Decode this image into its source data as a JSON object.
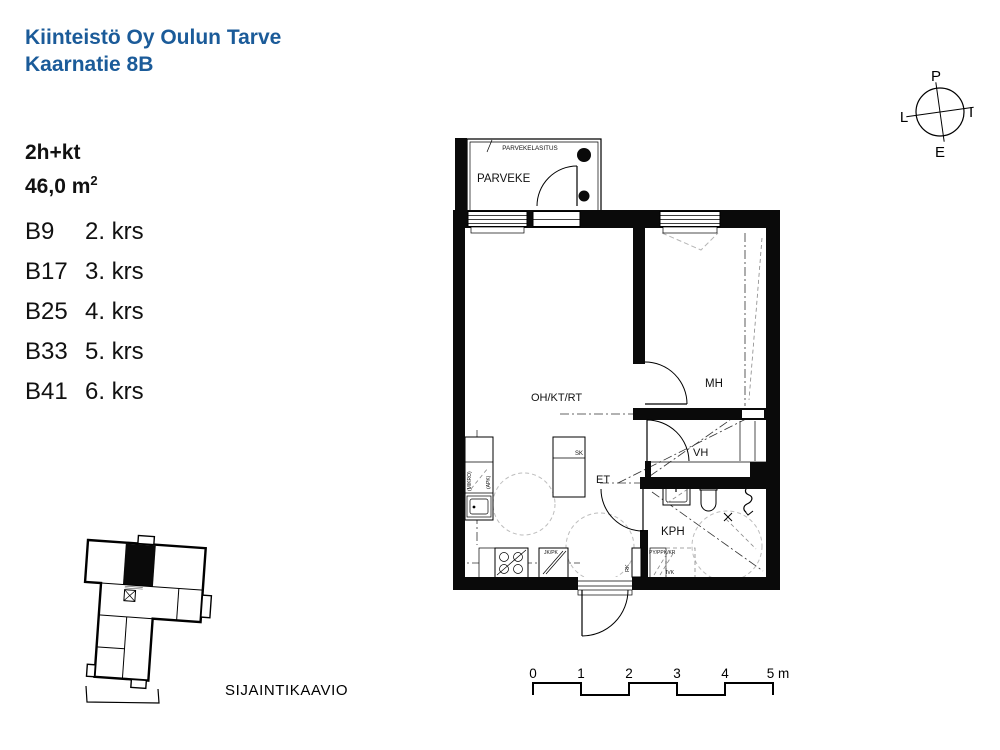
{
  "title": {
    "line1": "Kiinteistö Oy Oulun Tarve",
    "line2": "Kaarnatie 8B"
  },
  "apartment": {
    "layout": "2h+kt",
    "area": "46,0 m",
    "area_exponent": "2"
  },
  "units": [
    {
      "code": "B9",
      "floor": "2. krs"
    },
    {
      "code": "B17",
      "floor": "3. krs"
    },
    {
      "code": "B25",
      "floor": "4. krs"
    },
    {
      "code": "B33",
      "floor": "5. krs"
    },
    {
      "code": "B41",
      "floor": "6. krs"
    }
  ],
  "floorplan": {
    "balcony_glazing_label": "PARVEKELASITUS",
    "balcony_label": "PARVEKE",
    "living_label": "OH/KT/RT",
    "bedroom_label": "MH",
    "closet_label": "VH",
    "hall_label": "ET",
    "bathroom_label": "KPH",
    "broom_closet_label": "SK",
    "electrical_label": "RK",
    "fridge_label": "JK/PK",
    "microwave_label": "(MIKRO)",
    "dishwasher_label": "(APK)",
    "laundry_label": "PY/PPK/KR",
    "vent_label": "IVK"
  },
  "compass": {
    "north": "P",
    "east": "I",
    "south": "E",
    "west": "L"
  },
  "scale_bar": {
    "ticks": [
      "0",
      "1",
      "2",
      "3",
      "4"
    ],
    "end_label": "5 m"
  },
  "location_diagram": {
    "caption": "SIJAINTIKAAVIO"
  },
  "colors": {
    "accent": "#1b5b99",
    "line": "#000000"
  }
}
